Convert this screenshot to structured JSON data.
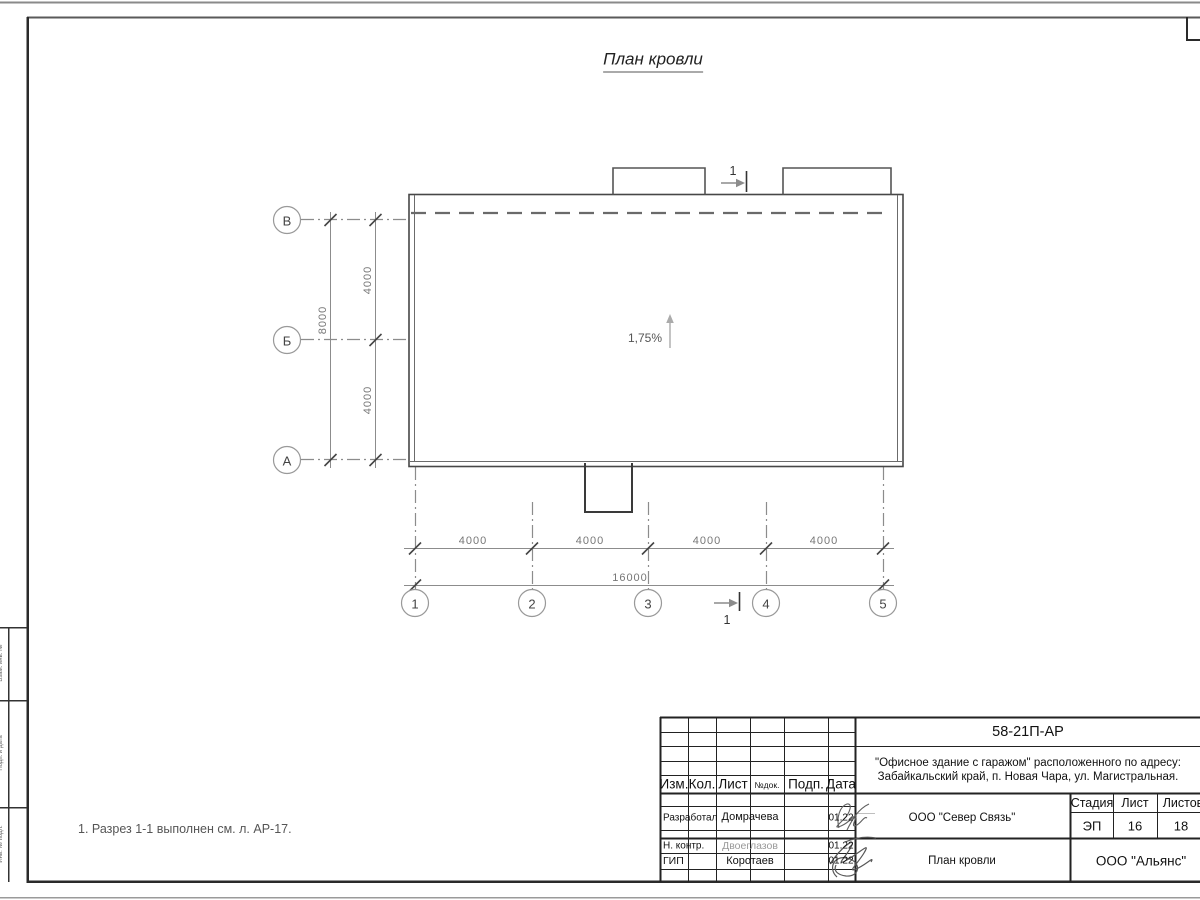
{
  "sheet": {
    "title": "План кровли",
    "note": "1. Разрез 1-1 выполнен см. л. АР-17.",
    "slope": "1,75%",
    "section_mark": "1"
  },
  "axes": {
    "bottom": [
      "1",
      "2",
      "3",
      "4",
      "5"
    ],
    "left": [
      "В",
      "Б",
      "А"
    ]
  },
  "dims": {
    "bottom_bays": [
      "4000",
      "4000",
      "4000",
      "4000"
    ],
    "bottom_total": "16000",
    "left_bays": [
      "4000",
      "4000"
    ],
    "left_total": "8000"
  },
  "title_block": {
    "doc_number": "58-21П-АР",
    "project_line1": "\"Офисное здание с гаражом\" расположенного по адресу:",
    "project_line2": "Забайкальский край, п. Новая Чара, ул. Магистральная.",
    "col_izm": "Изм.",
    "col_kol": "Кол.",
    "col_list": "Лист",
    "col_ndok": "№док.",
    "col_podp": "Подп.",
    "col_data": "Дата",
    "row1_role": "Разработал",
    "row1_name": "Домрачева",
    "row1_date": "01.22",
    "row2_role": "Н. контр.",
    "row2_name": "Двоеглазов",
    "row2_date": "01.22",
    "row3_role": "ГИП",
    "row3_name": "Коротаев",
    "row3_date": "01.22",
    "org": "ООО \"Север Связь\"",
    "sheet_name": "План кровли",
    "company": "ООО \"Альянс\"",
    "stage_label": "Стадия",
    "stage_value": "ЭП",
    "sheet_label": "Лист",
    "sheet_value": "16",
    "total_label": "Листов",
    "total_value": "18"
  },
  "side_stamp": {
    "labels": [
      "Взам. инв. №",
      "Подп. и дата",
      "Инв. № подл."
    ]
  }
}
